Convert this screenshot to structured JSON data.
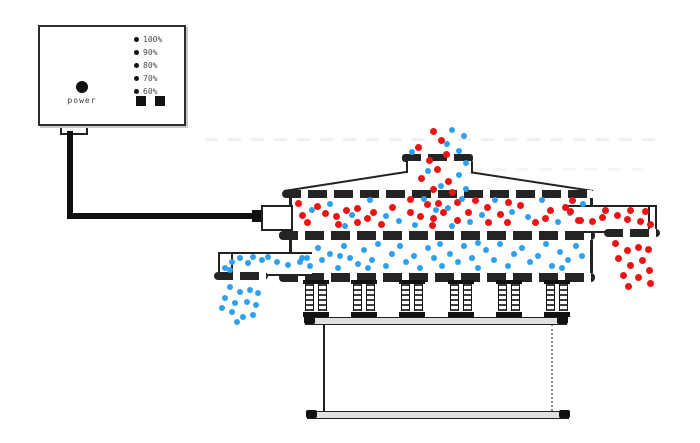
{
  "panel": {
    "power_label": "power",
    "power_button_icon": "filled-circle",
    "levels": [
      "100%",
      "90%",
      "80%",
      "70%",
      "60%"
    ],
    "indicator_bullet_icon": "filled-dot",
    "square_button_icon": "filled-square"
  },
  "colors": {
    "coarse_particle_red": "#ea1414",
    "fine_particle_blue": "#2f9ff0",
    "line_art": "#222222",
    "cable_black": "#101010"
  },
  "particles": [
    {
      "name": "feed-coarse",
      "color": "#ea1414",
      "size": 7,
      "points": [
        [
          433,
          131
        ],
        [
          441,
          140
        ],
        [
          418,
          147
        ],
        [
          446,
          154
        ],
        [
          429,
          160
        ],
        [
          437,
          169
        ],
        [
          421,
          178
        ],
        [
          448,
          181
        ],
        [
          433,
          189
        ],
        [
          452,
          192
        ]
      ]
    },
    {
      "name": "feed-fine",
      "color": "#2f9ff0",
      "size": 6,
      "points": [
        [
          452,
          130
        ],
        [
          464,
          136
        ],
        [
          447,
          144
        ],
        [
          412,
          152
        ],
        [
          459,
          151
        ],
        [
          466,
          163
        ],
        [
          428,
          171
        ],
        [
          459,
          175
        ],
        [
          441,
          186
        ],
        [
          466,
          189
        ]
      ]
    },
    {
      "name": "upper-deck-coarse",
      "color": "#ea1414",
      "size": 7,
      "points": [
        [
          298,
          203
        ],
        [
          317,
          206
        ],
        [
          307,
          222
        ],
        [
          325,
          213
        ],
        [
          336,
          216
        ],
        [
          346,
          210
        ],
        [
          338,
          224
        ],
        [
          357,
          208
        ],
        [
          357,
          222
        ],
        [
          373,
          212
        ],
        [
          381,
          224
        ],
        [
          392,
          207
        ],
        [
          410,
          199
        ],
        [
          410,
          212
        ],
        [
          420,
          216
        ],
        [
          427,
          204
        ],
        [
          438,
          203
        ],
        [
          443,
          212
        ],
        [
          457,
          202
        ],
        [
          457,
          220
        ],
        [
          468,
          212
        ],
        [
          487,
          207
        ],
        [
          500,
          214
        ],
        [
          508,
          202
        ],
        [
          507,
          222
        ],
        [
          520,
          205
        ],
        [
          535,
          222
        ],
        [
          550,
          210
        ],
        [
          565,
          207
        ],
        [
          578,
          220
        ],
        [
          302,
          215
        ],
        [
          367,
          218
        ],
        [
          432,
          225
        ],
        [
          475,
          200
        ],
        [
          545,
          218
        ],
        [
          572,
          200
        ],
        [
          488,
          222
        ],
        [
          433,
          218
        ]
      ]
    },
    {
      "name": "upper-deck-fine",
      "color": "#2f9ff0",
      "size": 6,
      "points": [
        [
          312,
          210
        ],
        [
          330,
          204
        ],
        [
          352,
          215
        ],
        [
          345,
          226
        ],
        [
          370,
          200
        ],
        [
          386,
          216
        ],
        [
          399,
          221
        ],
        [
          415,
          225
        ],
        [
          424,
          199
        ],
        [
          436,
          210
        ],
        [
          448,
          208
        ],
        [
          452,
          226
        ],
        [
          470,
          222
        ],
        [
          482,
          215
        ],
        [
          495,
          200
        ],
        [
          512,
          212
        ],
        [
          528,
          217
        ],
        [
          542,
          200
        ],
        [
          558,
          222
        ],
        [
          570,
          213
        ],
        [
          583,
          204
        ],
        [
          462,
          199
        ]
      ]
    },
    {
      "name": "lower-deck-fine",
      "color": "#2f9ff0",
      "size": 6,
      "points": [
        [
          302,
          258
        ],
        [
          310,
          266
        ],
        [
          318,
          248
        ],
        [
          322,
          260
        ],
        [
          330,
          254
        ],
        [
          338,
          268
        ],
        [
          344,
          246
        ],
        [
          350,
          258
        ],
        [
          358,
          264
        ],
        [
          364,
          250
        ],
        [
          372,
          260
        ],
        [
          378,
          244
        ],
        [
          386,
          266
        ],
        [
          392,
          254
        ],
        [
          400,
          246
        ],
        [
          406,
          262
        ],
        [
          414,
          256
        ],
        [
          420,
          268
        ],
        [
          428,
          248
        ],
        [
          434,
          258
        ],
        [
          440,
          244
        ],
        [
          442,
          266
        ],
        [
          450,
          254
        ],
        [
          458,
          262
        ],
        [
          464,
          246
        ],
        [
          472,
          258
        ],
        [
          478,
          268
        ],
        [
          486,
          250
        ],
        [
          494,
          260
        ],
        [
          500,
          244
        ],
        [
          508,
          266
        ],
        [
          514,
          254
        ],
        [
          522,
          248
        ],
        [
          530,
          262
        ],
        [
          538,
          256
        ],
        [
          546,
          244
        ],
        [
          552,
          266
        ],
        [
          560,
          252
        ],
        [
          568,
          260
        ],
        [
          576,
          246
        ],
        [
          582,
          256
        ],
        [
          340,
          256
        ],
        [
          368,
          268
        ],
        [
          478,
          243
        ],
        [
          562,
          268
        ]
      ]
    },
    {
      "name": "coarse-outlet-flow",
      "color": "#ea1414",
      "size": 7,
      "points": [
        [
          570,
          211
        ],
        [
          580,
          220
        ],
        [
          592,
          221
        ],
        [
          602,
          217
        ],
        [
          605,
          210
        ],
        [
          617,
          215
        ],
        [
          627,
          219
        ],
        [
          630,
          210
        ],
        [
          640,
          221
        ],
        [
          645,
          211
        ],
        [
          650,
          224
        ]
      ]
    },
    {
      "name": "coarse-discharge",
      "color": "#ea1414",
      "size": 7,
      "points": [
        [
          615,
          243
        ],
        [
          627,
          250
        ],
        [
          638,
          247
        ],
        [
          648,
          249
        ],
        [
          618,
          258
        ],
        [
          630,
          265
        ],
        [
          642,
          260
        ],
        [
          649,
          270
        ],
        [
          623,
          275
        ],
        [
          638,
          277
        ],
        [
          628,
          286
        ],
        [
          650,
          283
        ]
      ]
    },
    {
      "name": "fine-outlet-flow",
      "color": "#2f9ff0",
      "size": 6,
      "points": [
        [
          225,
          268
        ],
        [
          232,
          262
        ],
        [
          240,
          258
        ],
        [
          248,
          263
        ],
        [
          253,
          257
        ],
        [
          262,
          260
        ],
        [
          268,
          257
        ],
        [
          277,
          262
        ],
        [
          288,
          265
        ],
        [
          300,
          262
        ],
        [
          307,
          258
        ],
        [
          230,
          270
        ]
      ]
    },
    {
      "name": "fine-discharge",
      "color": "#2f9ff0",
      "size": 6,
      "points": [
        [
          230,
          287
        ],
        [
          240,
          292
        ],
        [
          250,
          290
        ],
        [
          258,
          293
        ],
        [
          225,
          298
        ],
        [
          235,
          303
        ],
        [
          247,
          302
        ],
        [
          256,
          305
        ],
        [
          232,
          312
        ],
        [
          243,
          317
        ],
        [
          253,
          315
        ],
        [
          237,
          322
        ],
        [
          222,
          308
        ]
      ]
    }
  ]
}
